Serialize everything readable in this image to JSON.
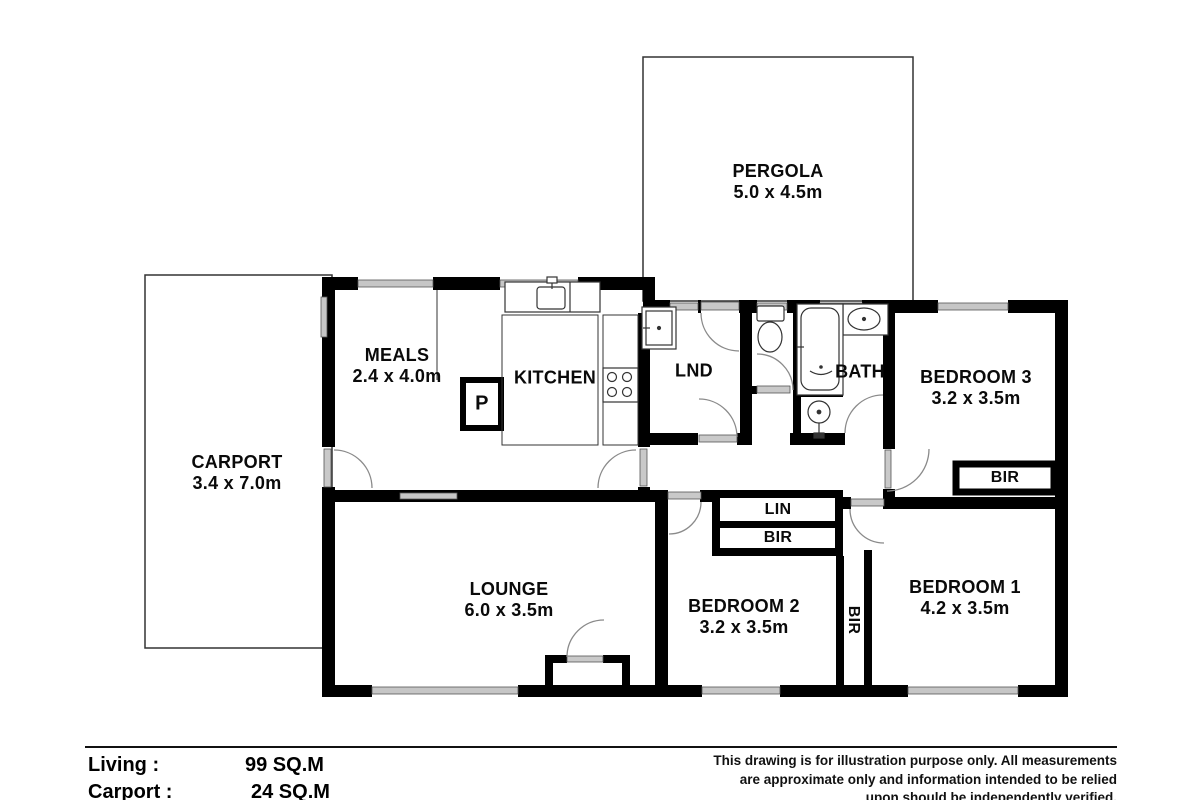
{
  "plan": {
    "rooms": {
      "pergola": {
        "name": "PERGOLA",
        "dims": "5.0 x 4.5m"
      },
      "carport": {
        "name": "CARPORT",
        "dims": "3.4 x 7.0m"
      },
      "meals": {
        "name": "MEALS",
        "dims": "2.4 x 4.0m"
      },
      "kitchen": {
        "name": "KITCHEN"
      },
      "pantry": {
        "name": "P"
      },
      "laundry": {
        "name": "LND"
      },
      "bath": {
        "name": "BATH"
      },
      "bedroom3": {
        "name": "BEDROOM 3",
        "dims": "3.2 x 3.5m"
      },
      "bedroom2": {
        "name": "BEDROOM 2",
        "dims": "3.2 x 3.5m"
      },
      "bedroom1": {
        "name": "BEDROOM 1",
        "dims": "4.2 x 3.5m"
      },
      "lounge": {
        "name": "LOUNGE",
        "dims": "6.0 x 3.5m"
      },
      "linen": {
        "name": "LIN"
      },
      "robe_hall": {
        "name": "BIR"
      },
      "robe_bed3": {
        "name": "BIR"
      },
      "robe_bed1": {
        "name": "BIR"
      }
    },
    "colors": {
      "wall": "#000000",
      "window_glass": "#c6c6c6",
      "door_leaf": "#c9c9c9",
      "door_arc": "#8a8a8a",
      "outline": "#333333"
    }
  },
  "footer": {
    "areas": [
      {
        "label": "Living :",
        "value": "99 SQ.M"
      },
      {
        "label": "Carport :",
        "value": "24 SQ.M"
      }
    ],
    "disclaimer": [
      "This drawing is for illustration purpose only. All measurements",
      "are approximate only and information intended to be relied",
      "upon should be independently verified."
    ]
  }
}
